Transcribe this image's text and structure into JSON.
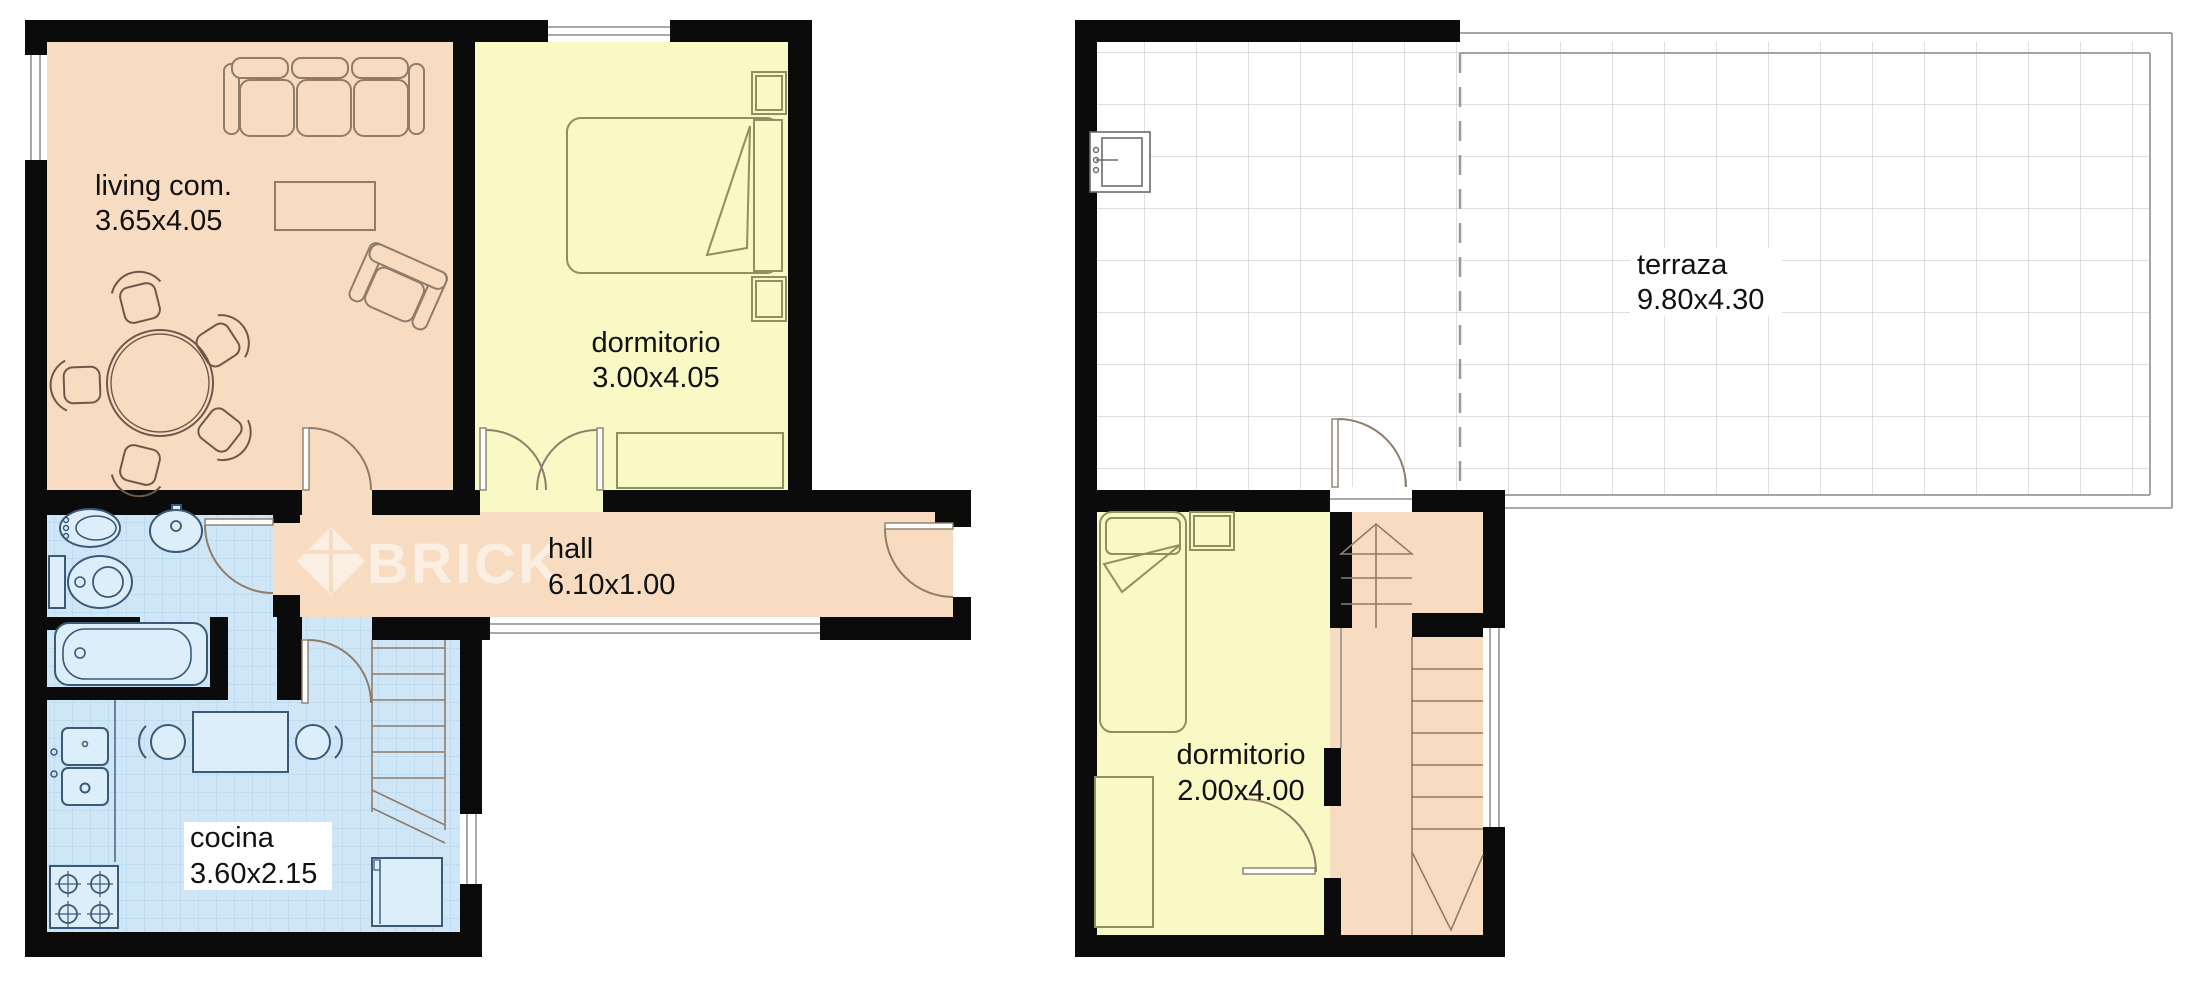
{
  "plans": {
    "floor1": {
      "rooms": {
        "living": {
          "name": "living com.",
          "dims": "3.65x4.05"
        },
        "bedroom": {
          "name": "dormitorio",
          "dims": "3.00x4.05"
        },
        "hall": {
          "name": "hall",
          "dims": "6.10x1.00"
        },
        "kitchen": {
          "name": "cocina",
          "dims": "3.60x2.15"
        }
      }
    },
    "floor2": {
      "rooms": {
        "terrace": {
          "name": "terraza",
          "dims": "9.80x4.30"
        },
        "bedroom": {
          "name": "dormitorio",
          "dims": "2.00x4.00"
        }
      }
    }
  },
  "watermark": {
    "text": "BRICK"
  },
  "colors": {
    "wall": "#0b0b0b",
    "peach": "#f8dcc2",
    "yellow": "#f9f9c5",
    "wet": "#cfe6f6",
    "tile": "#b0d2ea",
    "grid": "#cbcbcb",
    "wood": "#8f7d6a",
    "brown": "#6e5949",
    "olive": "#8f8f60",
    "fixture": "#3a5a78",
    "text": "#111111",
    "dash": "#9a9a9a"
  }
}
